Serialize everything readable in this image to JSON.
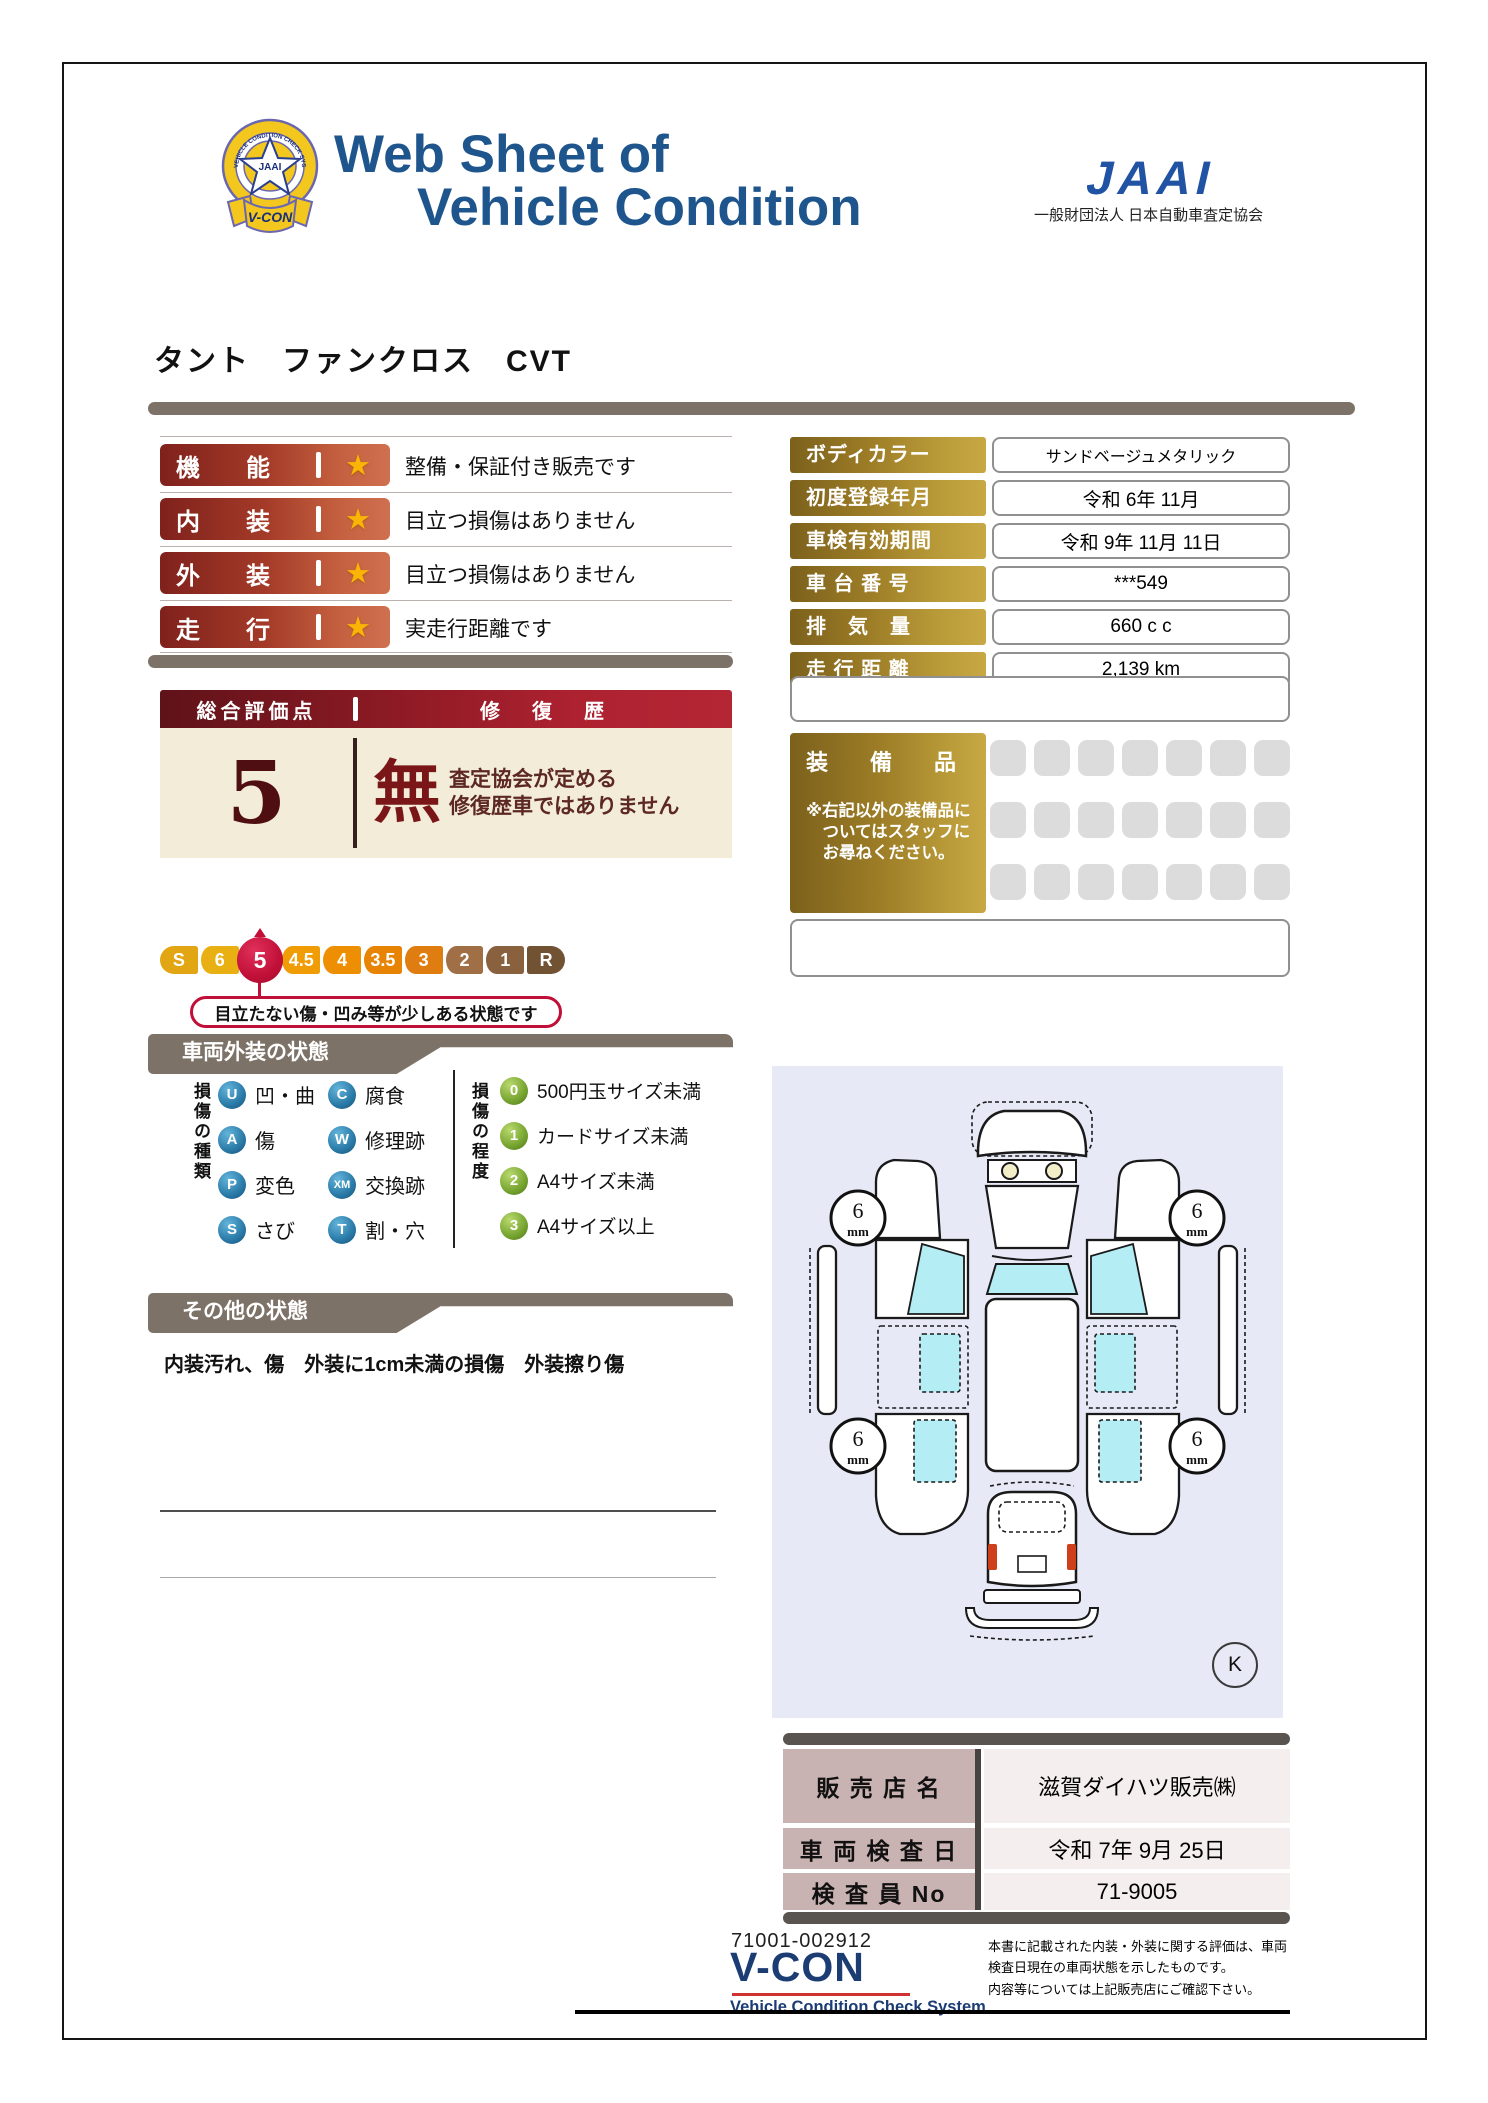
{
  "colors": {
    "title_blue": "#1d558c",
    "jaai_blue": "#2053a4",
    "accent_red": "#b22233",
    "crimson": "#c11038",
    "banner_gray": "#7d7268",
    "gold_dark": "#7c611c",
    "gold_light": "#c7a845",
    "navy": "#1c3c74",
    "lavender": "#e7eaf6",
    "badge_blue": "#2a7aa8",
    "badge_green": "#74a22e",
    "cream": "#f2ecd9"
  },
  "icons": {
    "star": "★"
  },
  "header": {
    "title_line1": "Web Sheet of",
    "title_line2": "Vehicle Condition",
    "jaai_logo": "JAAI",
    "jaai_org": "一般財団法人 日本自動車査定協会",
    "emblem_text": "V-CON",
    "emblem_jaai": "JAAI",
    "emblem_ring": "VEHICLE CONDITION CHECK SYSTEM"
  },
  "vehicle_title": "タント　ファンクロス　CVT",
  "ratings": [
    {
      "label": "機能",
      "desc": "整備・保証付き販売です"
    },
    {
      "label": "内装",
      "desc": "目立つ損傷はありません"
    },
    {
      "label": "外装",
      "desc": "目立つ損傷はありません"
    },
    {
      "label": "走行",
      "desc": "実走行距離です"
    }
  ],
  "overall": {
    "header_left": "総合評価点",
    "header_right": "修　復　歴",
    "score": "5",
    "repair_char": "無",
    "repair_line1": "査定協会が定める",
    "repair_line2": "修復歴車ではありません",
    "scale": [
      "S",
      "6",
      "5",
      "4.5",
      "4",
      "3.5",
      "3",
      "2",
      "1",
      "R"
    ],
    "selected": "5",
    "callout": "目立たない傷・凹み等が少しある状態です"
  },
  "info_table": {
    "rows": [
      {
        "label": "ボディカラー",
        "value": "サンドベージュメタリック"
      },
      {
        "label": "初度登録年月",
        "value": "令和 6年 11月"
      },
      {
        "label": "車検有効期間",
        "value": "令和 9年 11月 11日"
      },
      {
        "label": "車 台 番 号",
        "value": "***549"
      },
      {
        "label": "排　気　量",
        "value": "660 c c"
      },
      {
        "label": "走 行 距 離",
        "value": "2,139 km"
      }
    ]
  },
  "equipment": {
    "title": "装　備　品",
    "note": "※右記以外の装備品に\n　ついてはスタッフに\n　お尋ねください。"
  },
  "exterior": {
    "section_title": "車両外装の状態",
    "type_label": "損傷の種類",
    "types": [
      {
        "code": "U",
        "label": "凹・曲"
      },
      {
        "code": "A",
        "label": "傷"
      },
      {
        "code": "P",
        "label": "変色"
      },
      {
        "code": "S",
        "label": "さび"
      },
      {
        "code": "C",
        "label": "腐食"
      },
      {
        "code": "W",
        "label": "修理跡"
      },
      {
        "code": "XM",
        "label": "交換跡"
      },
      {
        "code": "T",
        "label": "割・穴"
      }
    ],
    "degree_label": "損傷の程度",
    "degrees": [
      {
        "code": "0",
        "label": "500円玉サイズ未満"
      },
      {
        "code": "1",
        "label": "カードサイズ未満"
      },
      {
        "code": "2",
        "label": "A4サイズ未満"
      },
      {
        "code": "3",
        "label": "A4サイズ以上"
      }
    ],
    "tire_depth": "6",
    "tire_unit": "mm",
    "key_mark": "K"
  },
  "other": {
    "section_title": "その他の状態",
    "note": "内装汚れ、傷　外装に1cm未満の損傷　外装擦り傷"
  },
  "dealer_table": {
    "rows": [
      {
        "label": "販 売 店 名",
        "value": "滋賀ダイハツ販売㈱"
      },
      {
        "label": "車 両 検 査 日",
        "value": "令和 7年 9月 25日"
      },
      {
        "label": "検 査 員 No",
        "value": "71-9005"
      }
    ]
  },
  "footer": {
    "serial": "71001-002912",
    "vcon": "V-CON",
    "vcon_sub": "Vehicle Condition Check System",
    "disclaimer_line1": "本書に記載された内装・外装に関する評価は、車両",
    "disclaimer_line2": "検査日現在の車両状態を示したものです。",
    "disclaimer_line3": "内容等については上記販売店にご確認下さい。"
  }
}
